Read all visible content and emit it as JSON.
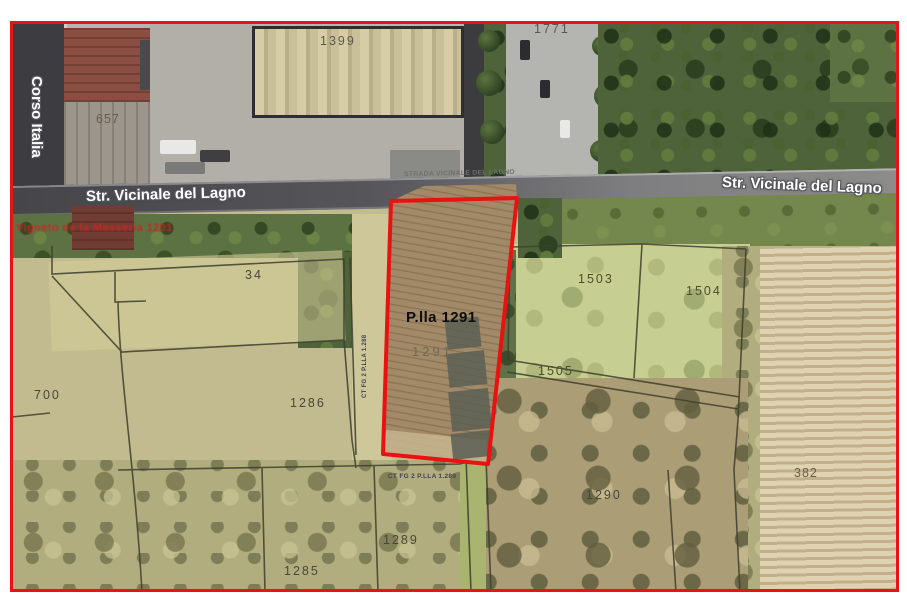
{
  "streets": {
    "corso_italia": "Corso Italia",
    "lagno_left": "Str. Vicinale del Lagno",
    "lagno_center_small": "STRADA VICINALE DEL LAGNO",
    "lagno_right": "Str. Vicinale del Lagno"
  },
  "highlight_parcel": {
    "label": "P.lla 1291",
    "number": "1291",
    "outline_color": "#ea1111"
  },
  "annotations": {
    "red_text": "Vigneto de la Masseria 1291",
    "ct_left_vertical": "CT FG 2 P.LLA 1.288",
    "ct_bottom": "CT FG 2 P.LLA 1.289"
  },
  "map_border_color": "#e81414",
  "parcel_labels": [
    {
      "id": "1399",
      "x": 320,
      "y": 34,
      "cls": "dim"
    },
    {
      "id": "1771",
      "x": 534,
      "y": 22,
      "cls": "dim"
    },
    {
      "id": "657",
      "x": 96,
      "y": 112,
      "cls": "soil"
    },
    {
      "id": "34",
      "x": 245,
      "y": 268,
      "cls": ""
    },
    {
      "id": "700",
      "x": 34,
      "y": 388,
      "cls": ""
    },
    {
      "id": "1286",
      "x": 290,
      "y": 396,
      "cls": ""
    },
    {
      "id": "1503",
      "x": 578,
      "y": 272,
      "cls": "olive"
    },
    {
      "id": "1504",
      "x": 686,
      "y": 284,
      "cls": "olive"
    },
    {
      "id": "1505",
      "x": 538,
      "y": 364,
      "cls": "olive"
    },
    {
      "id": "1290",
      "x": 586,
      "y": 488,
      "cls": ""
    },
    {
      "id": "382",
      "x": 794,
      "y": 466,
      "cls": "soil"
    },
    {
      "id": "1289",
      "x": 383,
      "y": 533,
      "cls": ""
    },
    {
      "id": "1285",
      "x": 284,
      "y": 564,
      "cls": ""
    }
  ]
}
